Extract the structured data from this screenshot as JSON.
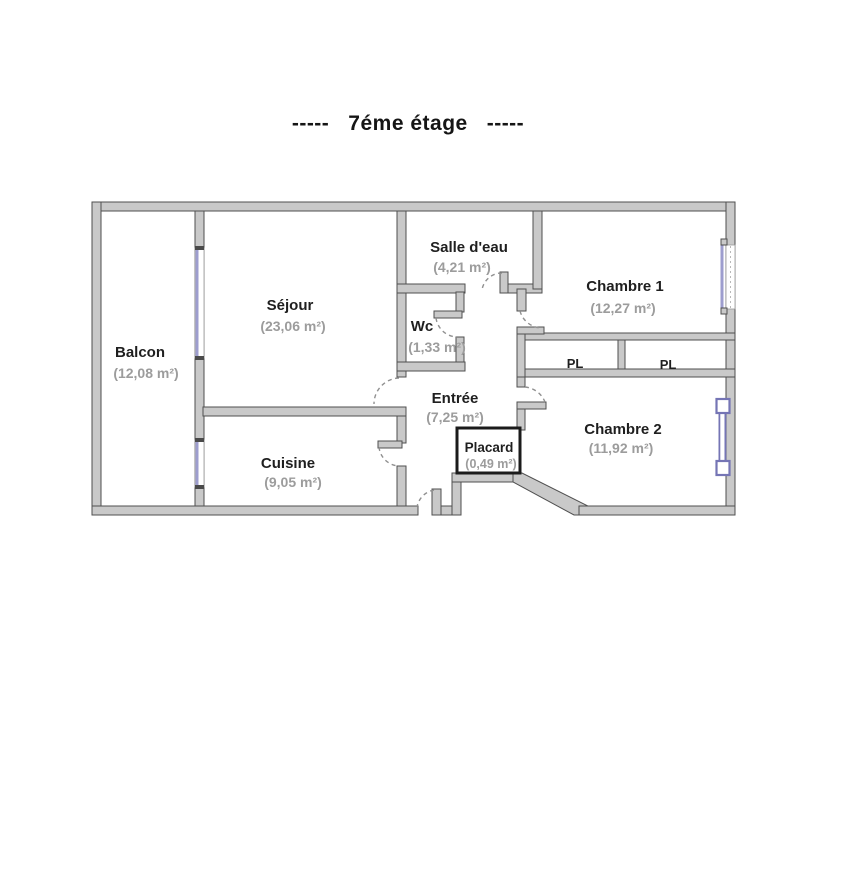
{
  "title": "-----   7éme étage   -----",
  "rooms": {
    "balcon": {
      "name": "Balcon",
      "area": "(12,08 m²)"
    },
    "sejour": {
      "name": "Séjour",
      "area": "(23,06 m²)"
    },
    "salle_deau": {
      "name": "Salle d'eau",
      "area": "(4,21 m²)"
    },
    "wc": {
      "name": "Wc",
      "area": "(1,33 m²)"
    },
    "chambre1": {
      "name": "Chambre 1",
      "area": "(12,27 m²)"
    },
    "entree": {
      "name": "Entrée",
      "area": "(7,25 m²)"
    },
    "cuisine": {
      "name": "Cuisine",
      "area": "(9,05 m²)"
    },
    "placard": {
      "name": "Placard",
      "area": "(0,49 m²)"
    },
    "chambre2": {
      "name": "Chambre 2",
      "area": "(11,92 m²)"
    }
  },
  "closets": {
    "pl_left": "PL",
    "pl_right": "PL"
  },
  "colors": {
    "wall_fill": "#c9c9c9",
    "wall_edge": "#4f4f4f",
    "placard_border": "#1b1b1b",
    "window_accent": "#9d9dce",
    "french_window": "#7575b5",
    "door_arc": "#909090",
    "room_name": "#1f1f1f",
    "room_area": "#9c9c9c"
  }
}
